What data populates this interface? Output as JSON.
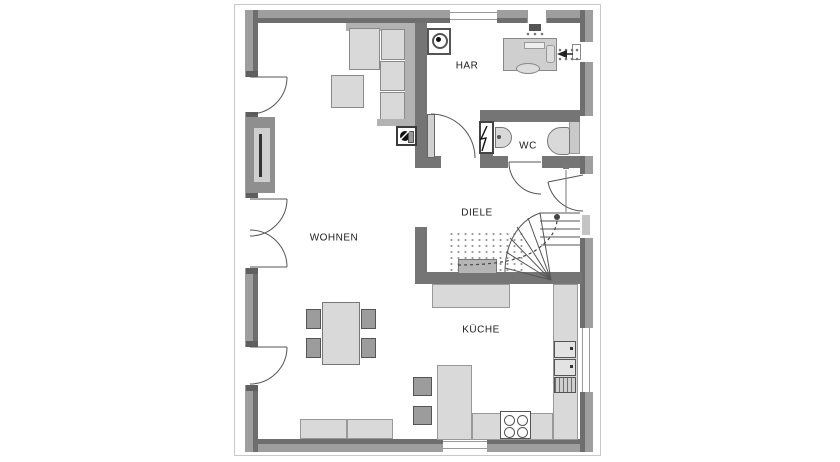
{
  "plan": {
    "type": "floor-plan-ground-floor",
    "rooms": {
      "living": "WOHNEN",
      "hall": "DIELE",
      "utility": "HAR",
      "wc": "WC",
      "kitchen": "KÜCHE"
    },
    "colors": {
      "wall_outer": "#9e9e9e",
      "wall_inner": "#6e6e6e",
      "wall_interior": "#757575",
      "furniture_light": "#d9d9d9",
      "furniture_mid": "#b2b2b2",
      "seat_dark": "#9c9c9c",
      "outline": "#c9c9c9",
      "line": "#555555"
    }
  }
}
